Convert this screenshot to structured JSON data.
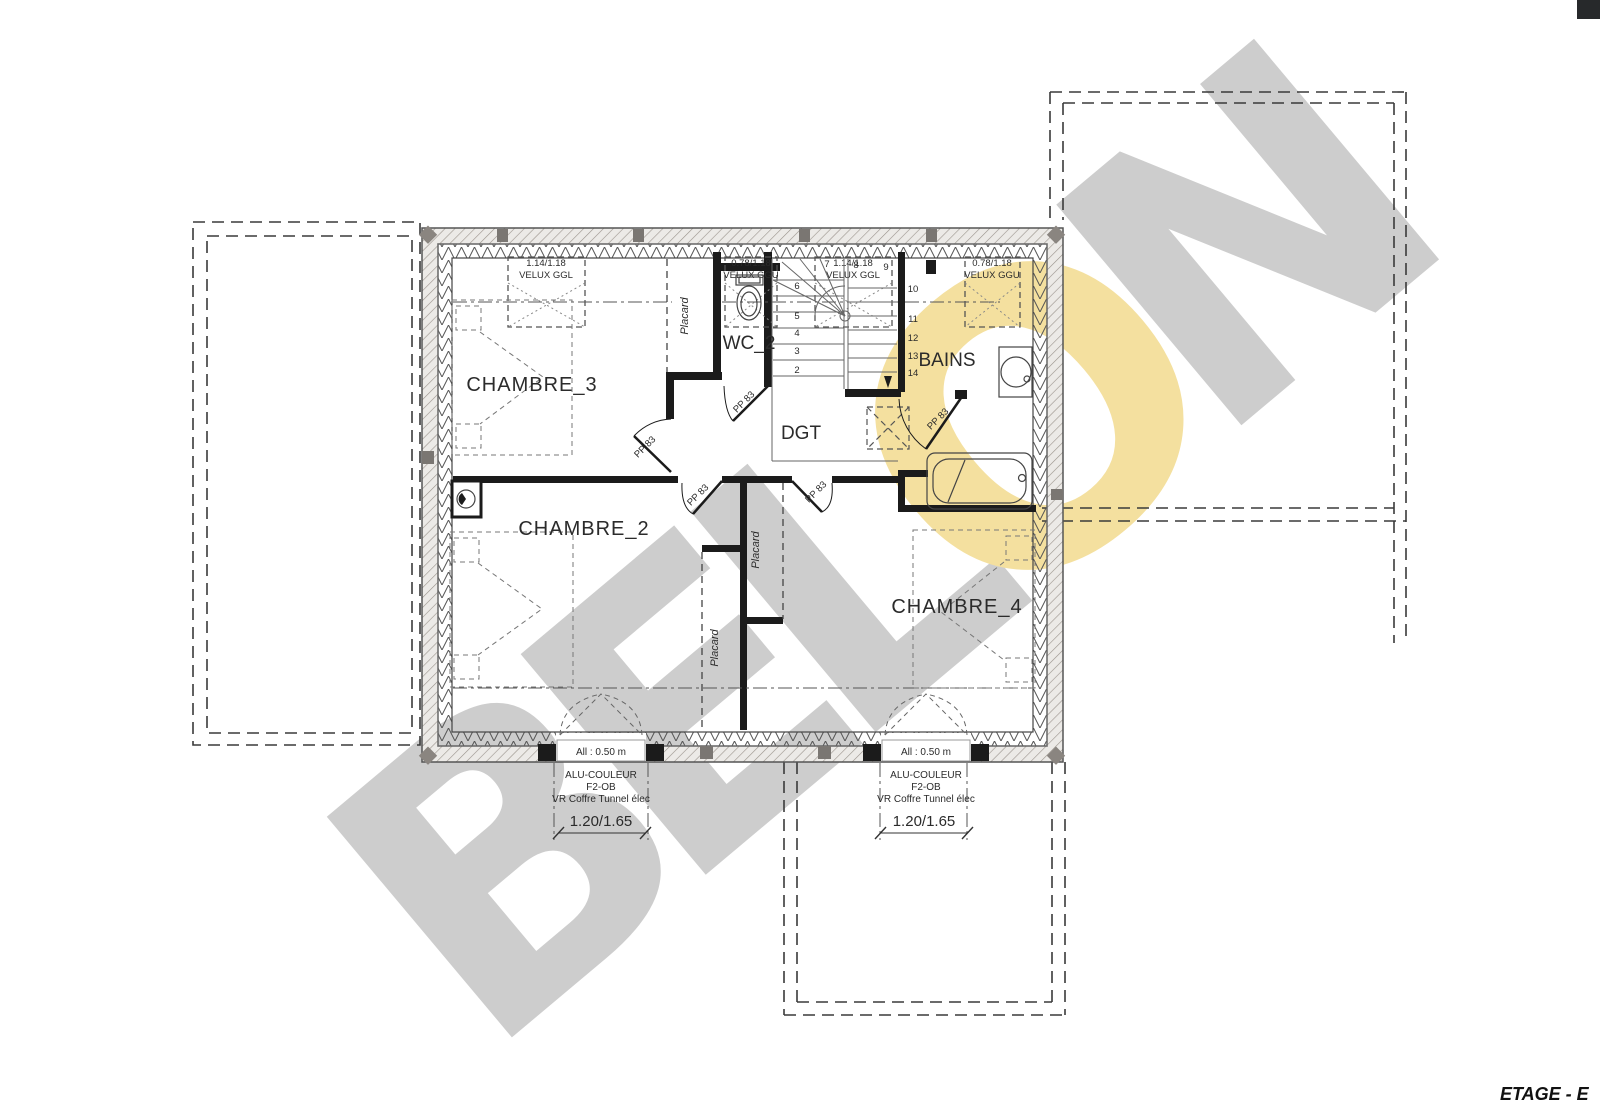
{
  "title": {
    "plan_label": "ETAGE - E"
  },
  "watermark": {
    "part1": "BEL",
    "part2": "O",
    "part3": "N",
    "gray": "#cdcdcd",
    "yellow": "#f4e09f"
  },
  "rooms": {
    "chambre3": "CHAMBRE_3",
    "wc2": "WC_2",
    "bains": "BAINS",
    "dgt": "DGT",
    "chambre2": "CHAMBRE_2",
    "chambre4": "CHAMBRE_4"
  },
  "closets": {
    "label": "Placard"
  },
  "doors": {
    "label": "PP 83"
  },
  "roof_windows": [
    {
      "dim": "1.14/1.18",
      "model": "VELUX GGL"
    },
    {
      "dim": "0.78/1.18",
      "model": "VELUX GGU"
    },
    {
      "dim": "1.14/1.18",
      "model": "VELUX GGL"
    },
    {
      "dim": "0.78/1.18",
      "model": "VELUX GGU"
    }
  ],
  "stairs": {
    "steps": [
      "2",
      "3",
      "4",
      "5",
      "6",
      "7",
      "8",
      "9",
      "10",
      "11",
      "12",
      "13",
      "14"
    ]
  },
  "windows_bottom": {
    "sill": "All : 0.50 m",
    "note1": "ALU-COULEUR",
    "note2": "F2-OB",
    "note3": "VR Coffre Tunnel élec",
    "dim": "1.20/1.65"
  },
  "colors": {
    "wall": "#1b1b1b",
    "line": "#444444"
  }
}
